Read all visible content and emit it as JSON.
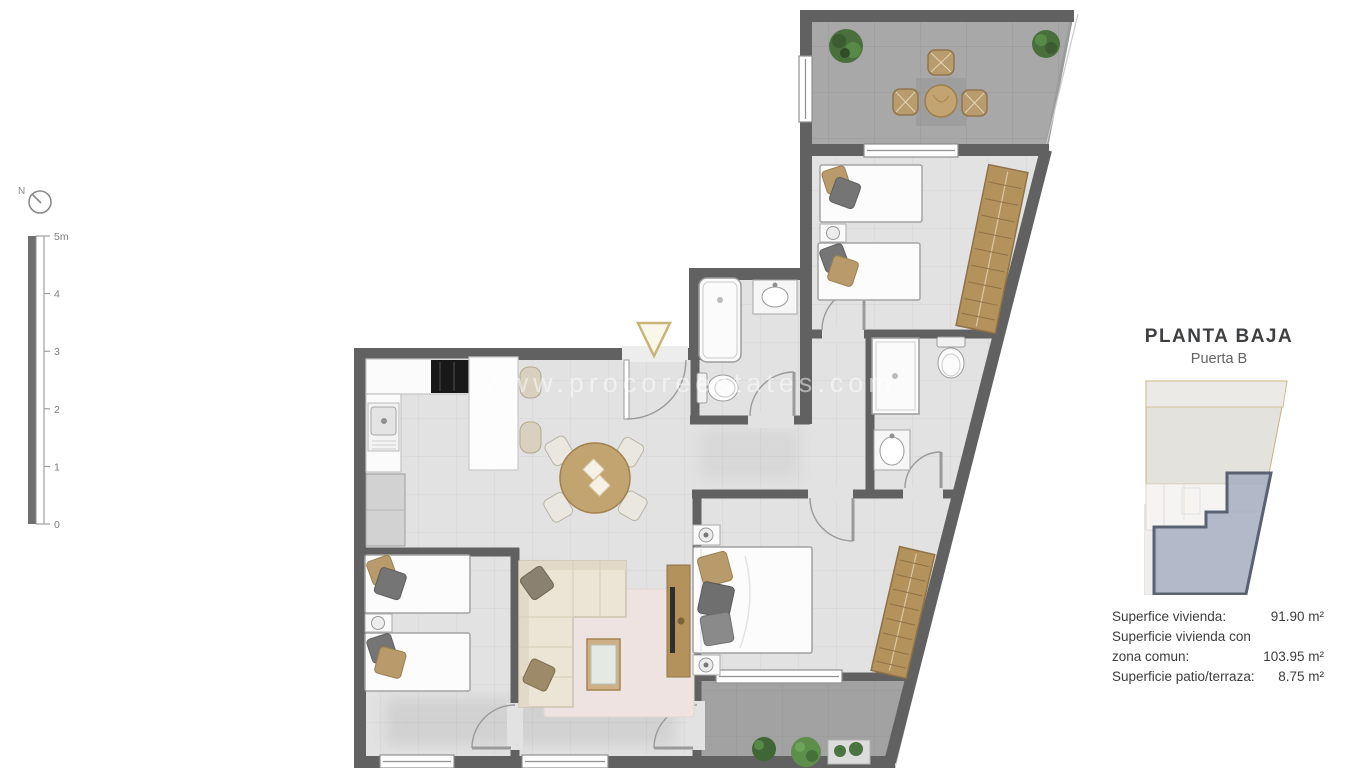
{
  "compass": {
    "label": "N"
  },
  "scalebar": {
    "labels": [
      "5m",
      "4",
      "3",
      "2",
      "1",
      "0"
    ]
  },
  "watermark": {
    "text": "www.procoreestates.com"
  },
  "info_panel": {
    "title": "PLANTA BAJA",
    "subtitle": "Puerta B",
    "areas": [
      {
        "label": "Superfice vivienda:",
        "value": "91.90 m²"
      },
      {
        "label": "Superficie vivienda con",
        "value": ""
      },
      {
        "label": "zona comun:",
        "value": "103.95 m²"
      },
      {
        "label": "Superficie patio/terraza:",
        "value": "8.75 m²"
      }
    ]
  },
  "colors": {
    "wall": "#616161",
    "interior_floor": "#e2e2e2",
    "terrace_floor": "#a8a8a8",
    "wood_accent": "#b3925c",
    "table_wood": "#c2a470",
    "keyplan_highlight": "#a4adc0",
    "keyplan_outline": "#c9b27f",
    "text": "#3c3c3c",
    "watermark": "#ffffff"
  }
}
